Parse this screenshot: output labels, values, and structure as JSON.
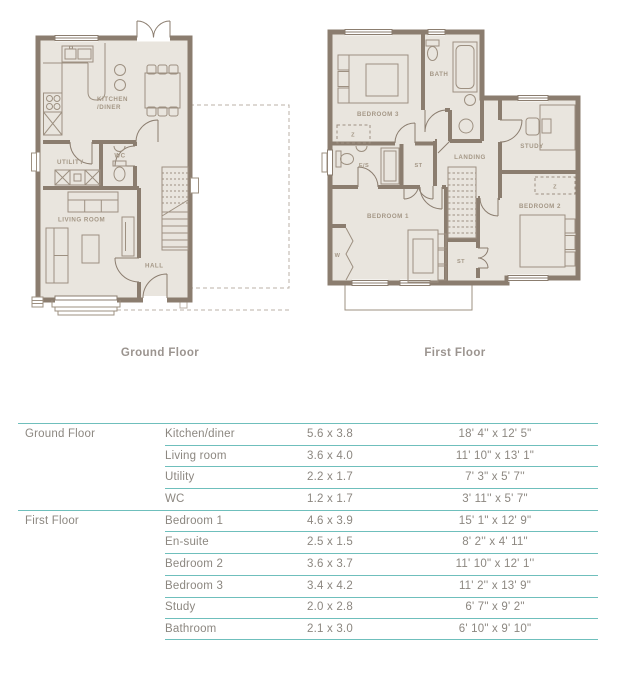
{
  "plans": {
    "ground": {
      "caption": "Ground Floor",
      "labels": {
        "kitchen_line1": "KITCHEN",
        "kitchen_line2": "/DINER",
        "utility": "UTILITY",
        "wc": "WC",
        "living": "LIVING ROOM",
        "hall": "HALL"
      }
    },
    "first": {
      "caption": "First Floor",
      "labels": {
        "bedroom3": "BEDROOM 3",
        "bath": "BATH",
        "study": "STUDY",
        "landing": "LANDING",
        "ensuite": "E/S",
        "store1": "ST",
        "store2": "ST",
        "bedroom1": "BEDROOM 1",
        "bedroom2": "BEDROOM 2",
        "wardrobe": "W",
        "zone1": "Z",
        "zone2": "Z"
      }
    }
  },
  "table": {
    "rows": [
      {
        "floor": "Ground Floor",
        "room": "Kitchen/diner",
        "metric": "5.6 x 3.8",
        "imperial": "18' 4'' x 12' 5\""
      },
      {
        "floor": "",
        "room": "Living room",
        "metric": "3.6 x 4.0",
        "imperial": "11' 10\" x 13' 1\""
      },
      {
        "floor": "",
        "room": "Utility",
        "metric": "2.2 x 1.7",
        "imperial": "7' 3\" x 5' 7''"
      },
      {
        "floor": "",
        "room": "WC",
        "metric": "1.2 x 1.7",
        "imperial": "3' 11'' x 5' 7\""
      },
      {
        "floor": "First Floor",
        "room": "Bedroom 1",
        "metric": "4.6 x 3.9",
        "imperial": "15' 1\" x 12' 9\""
      },
      {
        "floor": "",
        "room": "En-suite",
        "metric": "2.5 x 1.5",
        "imperial": "8' 2'' x 4' 11\""
      },
      {
        "floor": "",
        "room": "Bedroom 2",
        "metric": "3.6 x 3.7",
        "imperial": "11' 10\" x 12' 1''"
      },
      {
        "floor": "",
        "room": "Bedroom 3",
        "metric": "3.4 x 4.2",
        "imperial": "11' 2'' x 13' 9\""
      },
      {
        "floor": "",
        "room": "Study",
        "metric": "2.0 x 2.8",
        "imperial": "6' 7\" x 9' 2\""
      },
      {
        "floor": "",
        "room": "Bathroom",
        "metric": "2.1 x 3.0",
        "imperial": "6' 10\" x 9' 10\""
      }
    ]
  },
  "colors": {
    "accent_teal": "#6fbfbc",
    "wall": "#8b7d6f",
    "floor_fill": "#e9e5de",
    "room_label": "#a49786",
    "table_text": "#8c8780",
    "caption_text": "#9b948f",
    "dashed_outline": "#bbb2a7"
  }
}
